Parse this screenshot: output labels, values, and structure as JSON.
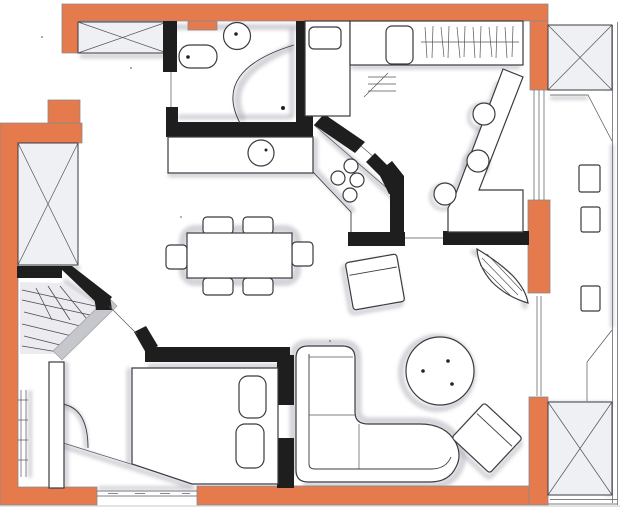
{
  "drawing": {
    "title": "Hand-drawn apartment floor plan sketch",
    "width_px": 620,
    "height_px": 507
  },
  "palette": {
    "paper": "#ffffff",
    "exterior_wall": "#e57a4d",
    "interior_wall": "#1e1e1e",
    "ink": "#3b3b40",
    "pencil_shade": "#a8a8b4",
    "paper_edge": "#c8c8cd"
  },
  "inventory": {
    "structure": [
      "exterior-orange-walls",
      "interior-black-walls",
      "crossed-corner-panels x4",
      "window-glazing x4",
      "balcony-strip",
      "entry-door-leaf",
      "bathroom-door-leaf",
      "bedroom-door-arc",
      "kitchen-diagonal-pass-wall"
    ],
    "bathroom": [
      "toilet",
      "round-washbasin",
      "corner-shower-screen",
      "floor-drain-dot"
    ],
    "kitchen": [
      "tall-cabinet",
      "counter-with-sink",
      "hatched-drainer-strip",
      "four-burner-hob",
      "sideboard-with-bowl",
      "bar-counter",
      "bar-stools x3"
    ],
    "dining": [
      "dining-table",
      "dining-chairs x6"
    ],
    "bedroom": [
      "double-bed",
      "pillows x2",
      "hatched-built-in-closet",
      "corridor-duct"
    ],
    "living": [
      "corner-sofa",
      "round-coffee-table",
      "cube-armchair",
      "rotated-armchair",
      "leaf-plant"
    ],
    "balcony": [
      "planter-boxes x3"
    ]
  }
}
